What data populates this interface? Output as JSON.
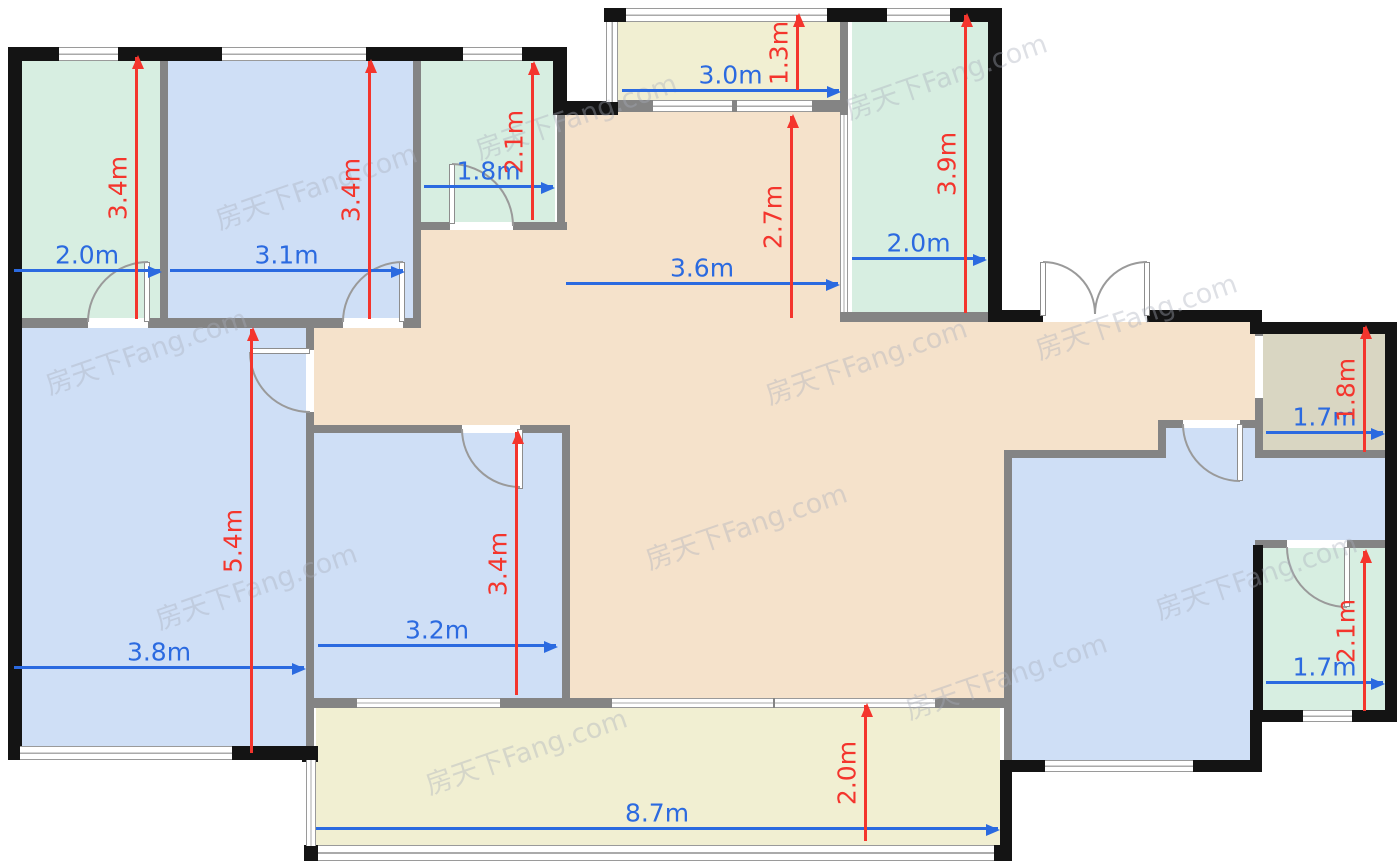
{
  "plan": {
    "watermark": "房天下Fang.com",
    "unit": "m"
  },
  "colors": {
    "room_blue": "#cfdff6",
    "room_green": "#d7eee1",
    "living_tan": "#f5e2cb",
    "balcony_yellow": "#f1efd2",
    "storage_olive": "#d9d6c2",
    "wall_black": "#141414",
    "wall_gray": "#848484",
    "dim_blue": "#2b6ae0",
    "dim_red": "#f4352d"
  },
  "rooms": [
    {
      "id": "bedroom-top-left",
      "w": "2.0m",
      "h": "3.4m"
    },
    {
      "id": "bedroom-top-middle",
      "w": "3.1m",
      "h": "3.4m"
    },
    {
      "id": "bathroom-top",
      "w": "1.8m",
      "h": "2.1m"
    },
    {
      "id": "balcony-top",
      "w": "3.0m",
      "h": "1.3m"
    },
    {
      "id": "living-dining",
      "w": "3.6m",
      "h": "2.7m"
    },
    {
      "id": "kitchen",
      "w": "2.0m",
      "h": "3.9m"
    },
    {
      "id": "storage-right",
      "w": "1.7m",
      "h": "1.8m"
    },
    {
      "id": "bedroom-left",
      "w": "3.8m",
      "h": "5.4m"
    },
    {
      "id": "bedroom-middle",
      "w": "3.2m",
      "h": "3.4m"
    },
    {
      "id": "bathroom-right",
      "w": "1.7m",
      "h": "2.1m"
    },
    {
      "id": "balcony-bottom",
      "w": "8.7m",
      "h": "2.0m"
    }
  ]
}
